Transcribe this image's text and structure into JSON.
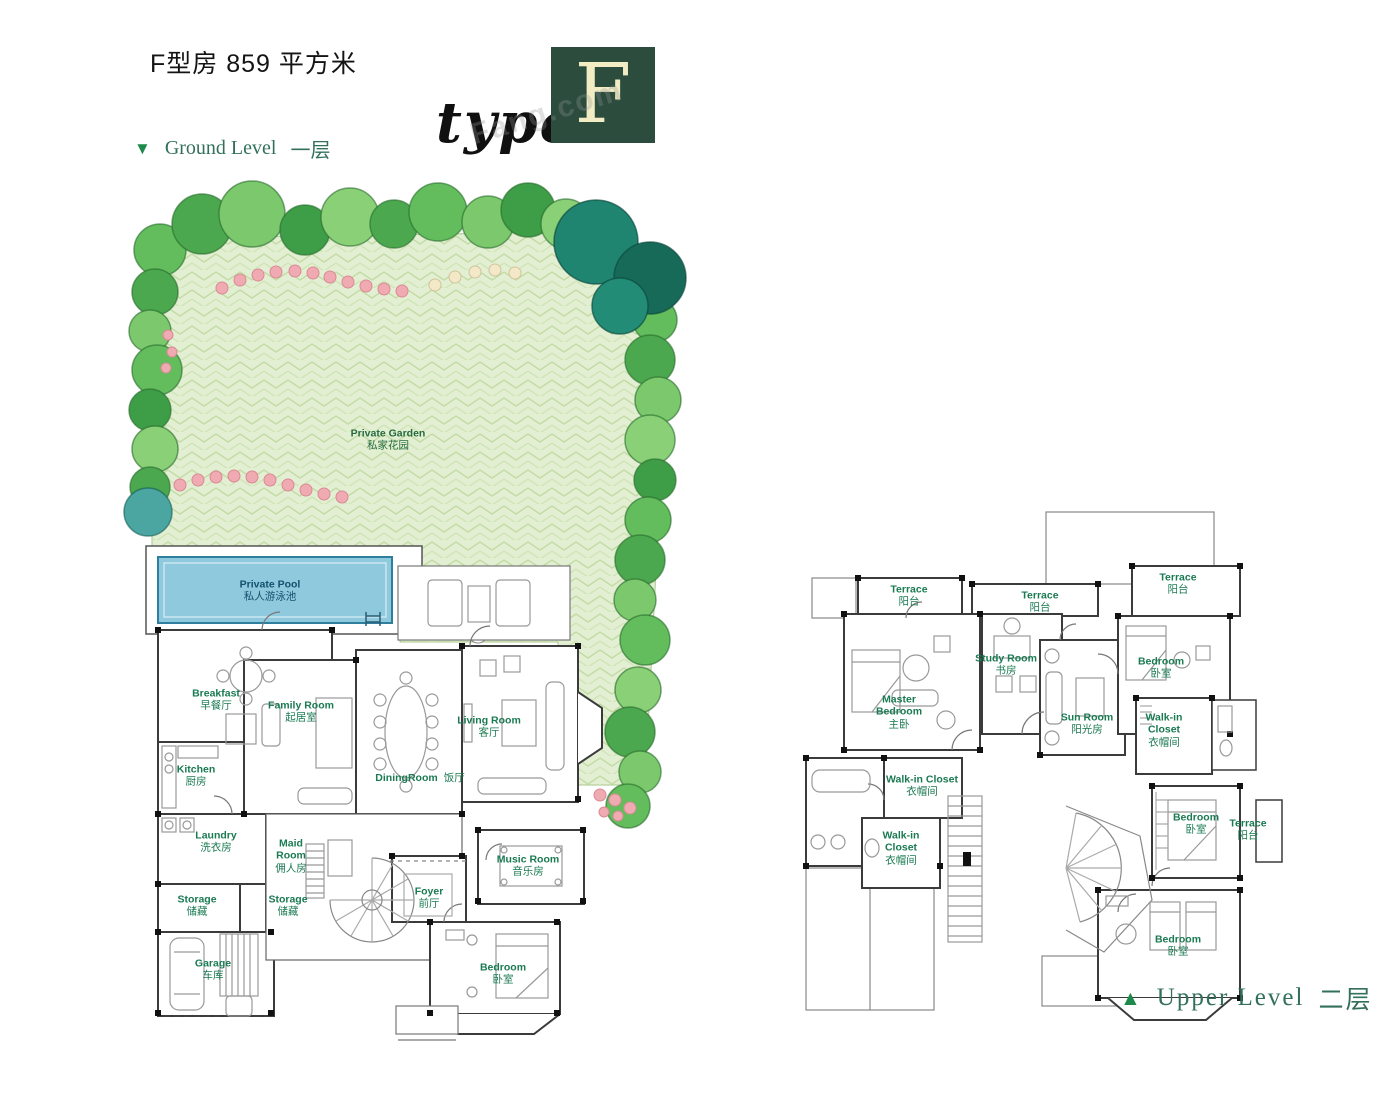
{
  "page": {
    "title": "F型房 859 平方米",
    "type_label": "type",
    "type_letter": "F",
    "watermark": "Fang.com"
  },
  "levels": {
    "ground": {
      "marker": "▼",
      "en": "Ground Level",
      "zh": "一层"
    },
    "upper": {
      "marker": "▲",
      "en": "Upper Level",
      "zh": "二层"
    }
  },
  "garden": {
    "en": "Private Garden",
    "zh": "私家花园"
  },
  "pool": {
    "en": "Private Pool",
    "zh": "私人游泳池"
  },
  "ground_rooms": {
    "breakfast": {
      "en": "Breakfast",
      "zh": "早餐厅"
    },
    "kitchen": {
      "en": "Kitchen",
      "zh": "厨房"
    },
    "family": {
      "en": "Family Room",
      "zh": "起居室"
    },
    "living": {
      "en": "Living Room",
      "zh": "客厅"
    },
    "dining": {
      "en": "DiningRoom",
      "zh": "饭厅"
    },
    "laundry": {
      "en": "Laundry",
      "zh": "洗衣房"
    },
    "maid": {
      "en": "Maid Room",
      "zh": "佣人房"
    },
    "storage1": {
      "en": "Storage",
      "zh": "储藏"
    },
    "storage2": {
      "en": "Storage",
      "zh": "储藏"
    },
    "garage": {
      "en": "Garage",
      "zh": "车库"
    },
    "foyer": {
      "en": "Foyer",
      "zh": "前厅"
    },
    "music": {
      "en": "Music Room",
      "zh": "音乐房"
    },
    "bedroom": {
      "en": "Bedroom",
      "zh": "卧室"
    }
  },
  "upper_rooms": {
    "terrace_tl": {
      "en": "Terrace",
      "zh": "阳台"
    },
    "terrace_tc": {
      "en": "Terrace",
      "zh": "阳台"
    },
    "terrace_tr": {
      "en": "Terrace",
      "zh": "阳台"
    },
    "master": {
      "en": "Master Bedroom",
      "zh": "主卧"
    },
    "study": {
      "en": "Study Room",
      "zh": "书房"
    },
    "sun": {
      "en": "Sun Room",
      "zh": "阳光房"
    },
    "bedroom_top": {
      "en": "Bedroom",
      "zh": "卧室"
    },
    "walkin_right": {
      "en": "Walk-in Closet",
      "zh": "衣帽间"
    },
    "walkin_mid": {
      "en": "Walk-in Closet",
      "zh": "衣帽间"
    },
    "walkin_low": {
      "en": "Walk-in Closet",
      "zh": "衣帽间"
    },
    "bedroom_mid": {
      "en": "Bedroom",
      "zh": "卧室"
    },
    "terrace_mid": {
      "en": "Terrace",
      "zh": "阳台"
    },
    "bedroom_bot": {
      "en": "Bedroom",
      "zh": "卧室"
    }
  },
  "colors": {
    "label_green": "#1a7a52",
    "level_green": "#33705c",
    "marker_green": "#1d8a4c",
    "logo_bg": "#2c4c3e",
    "logo_letter": "#f2ecc4",
    "pool_blue": "#8ec9dd",
    "lawn_green": "#e3efd2",
    "tree_green": "#58b35a",
    "tree_dark_teal": "#1f8570",
    "flower_pink": "#f0aab2"
  }
}
